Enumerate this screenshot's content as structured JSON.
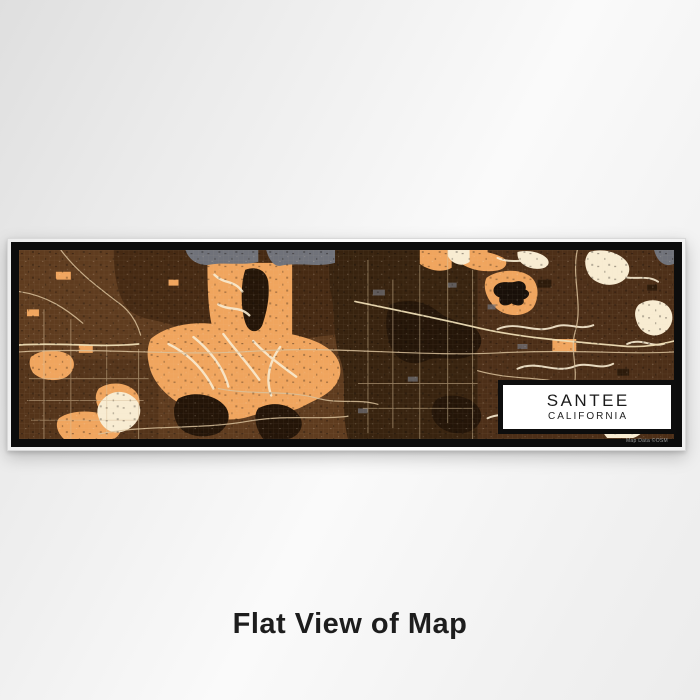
{
  "product": {
    "caption": "Flat View of Map",
    "label": {
      "city": "SANTEE",
      "state": "CALIFORNIA"
    },
    "attribution": "Map Data ©OSM",
    "palette": {
      "backdrop": "#ededed",
      "frame_black": "#0c0c0c",
      "mat_white": "#ffffff",
      "map_base": "#5f3c1f",
      "map_hill_dark": "#462a13",
      "map_center_dark": "#38230f",
      "map_right_region": "#4d2f18",
      "map_left_shadow": "#4a2d16",
      "map_orange": "#f0a55e",
      "map_dark_blob": "#241508",
      "map_lake": "#191009",
      "map_cream": "#f8ecd2",
      "map_gray": "#70727a",
      "map_road": "#d9c19b",
      "map_road_bright": "#eeddb5",
      "label_text": "#1a1a1a",
      "caption_text": "#1d1d1d"
    }
  }
}
